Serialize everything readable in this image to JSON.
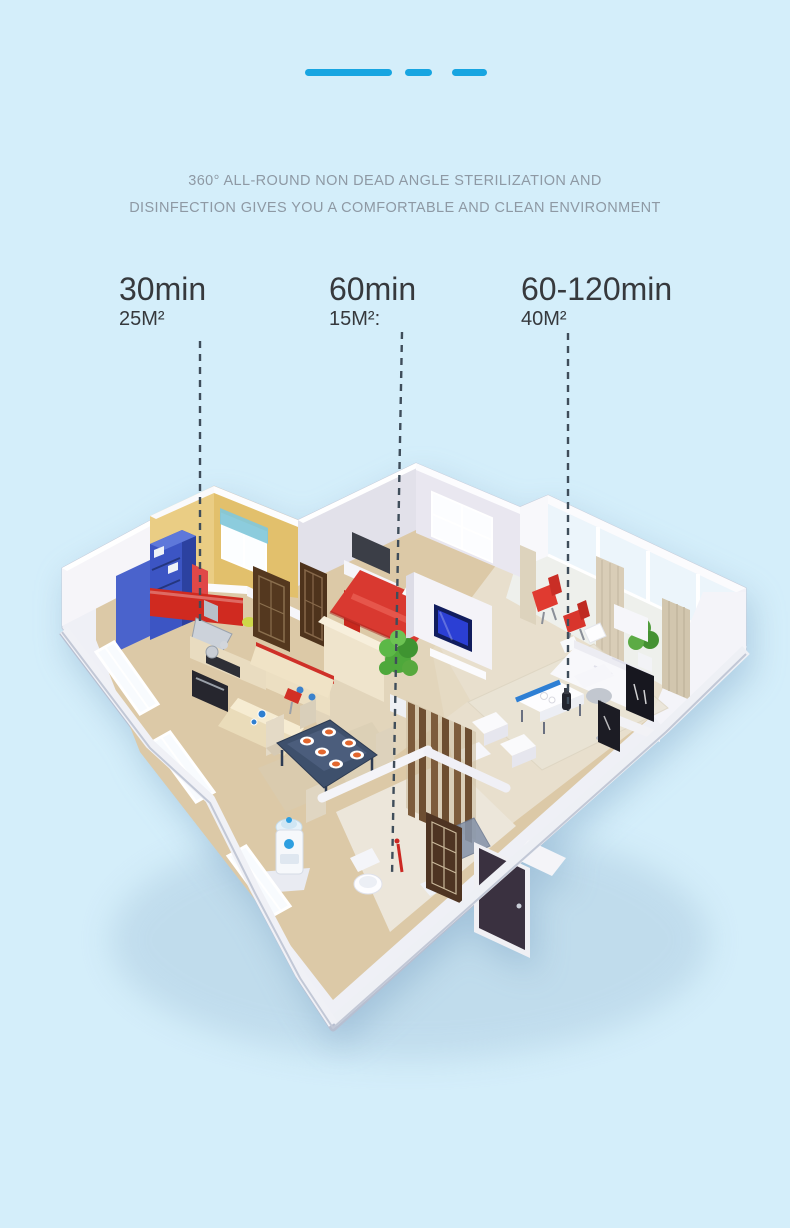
{
  "page": {
    "background_color": "#d4eefa",
    "accent_blue": "#17a5e1",
    "headline_color": "#8e99a4",
    "annotation_text_color": "#36393d",
    "leader_line_color": "#3f4d5a"
  },
  "headline": {
    "line1": "360° ALL-ROUND NON DEAD ANGLE STERILIZATION AND",
    "line2": "DISINFECTION GIVES YOU A COMFORTABLE AND CLEAN ENVIRONMENT"
  },
  "annotations": [
    {
      "time": "30min",
      "area": "25M²"
    },
    {
      "time": "60min",
      "area": "15M²:"
    },
    {
      "time": "60-120min",
      "area": "40M²"
    }
  ],
  "floor_plan": {
    "style": "isometric 3D apartment cutaway",
    "colors": {
      "floor_wood": "#dcc9a7",
      "outer_wall_white": "#f6f5f9",
      "kitchen_wall_yellow": "#e2c06c",
      "cabinet_red": "#d02a20",
      "shelf_blue": "#3c55c4",
      "bed_red": "#d93930",
      "tv_screen_blue": "#2b3fd4",
      "balcony_chair_red": "#e03a30",
      "plant_green": "#4ea83b",
      "curtain_beige": "#d9cdb7",
      "dining_table_dark": "#3e506c",
      "plate_orange": "#e2672e",
      "water_dispenser_blue": "#2e9fe0"
    }
  }
}
